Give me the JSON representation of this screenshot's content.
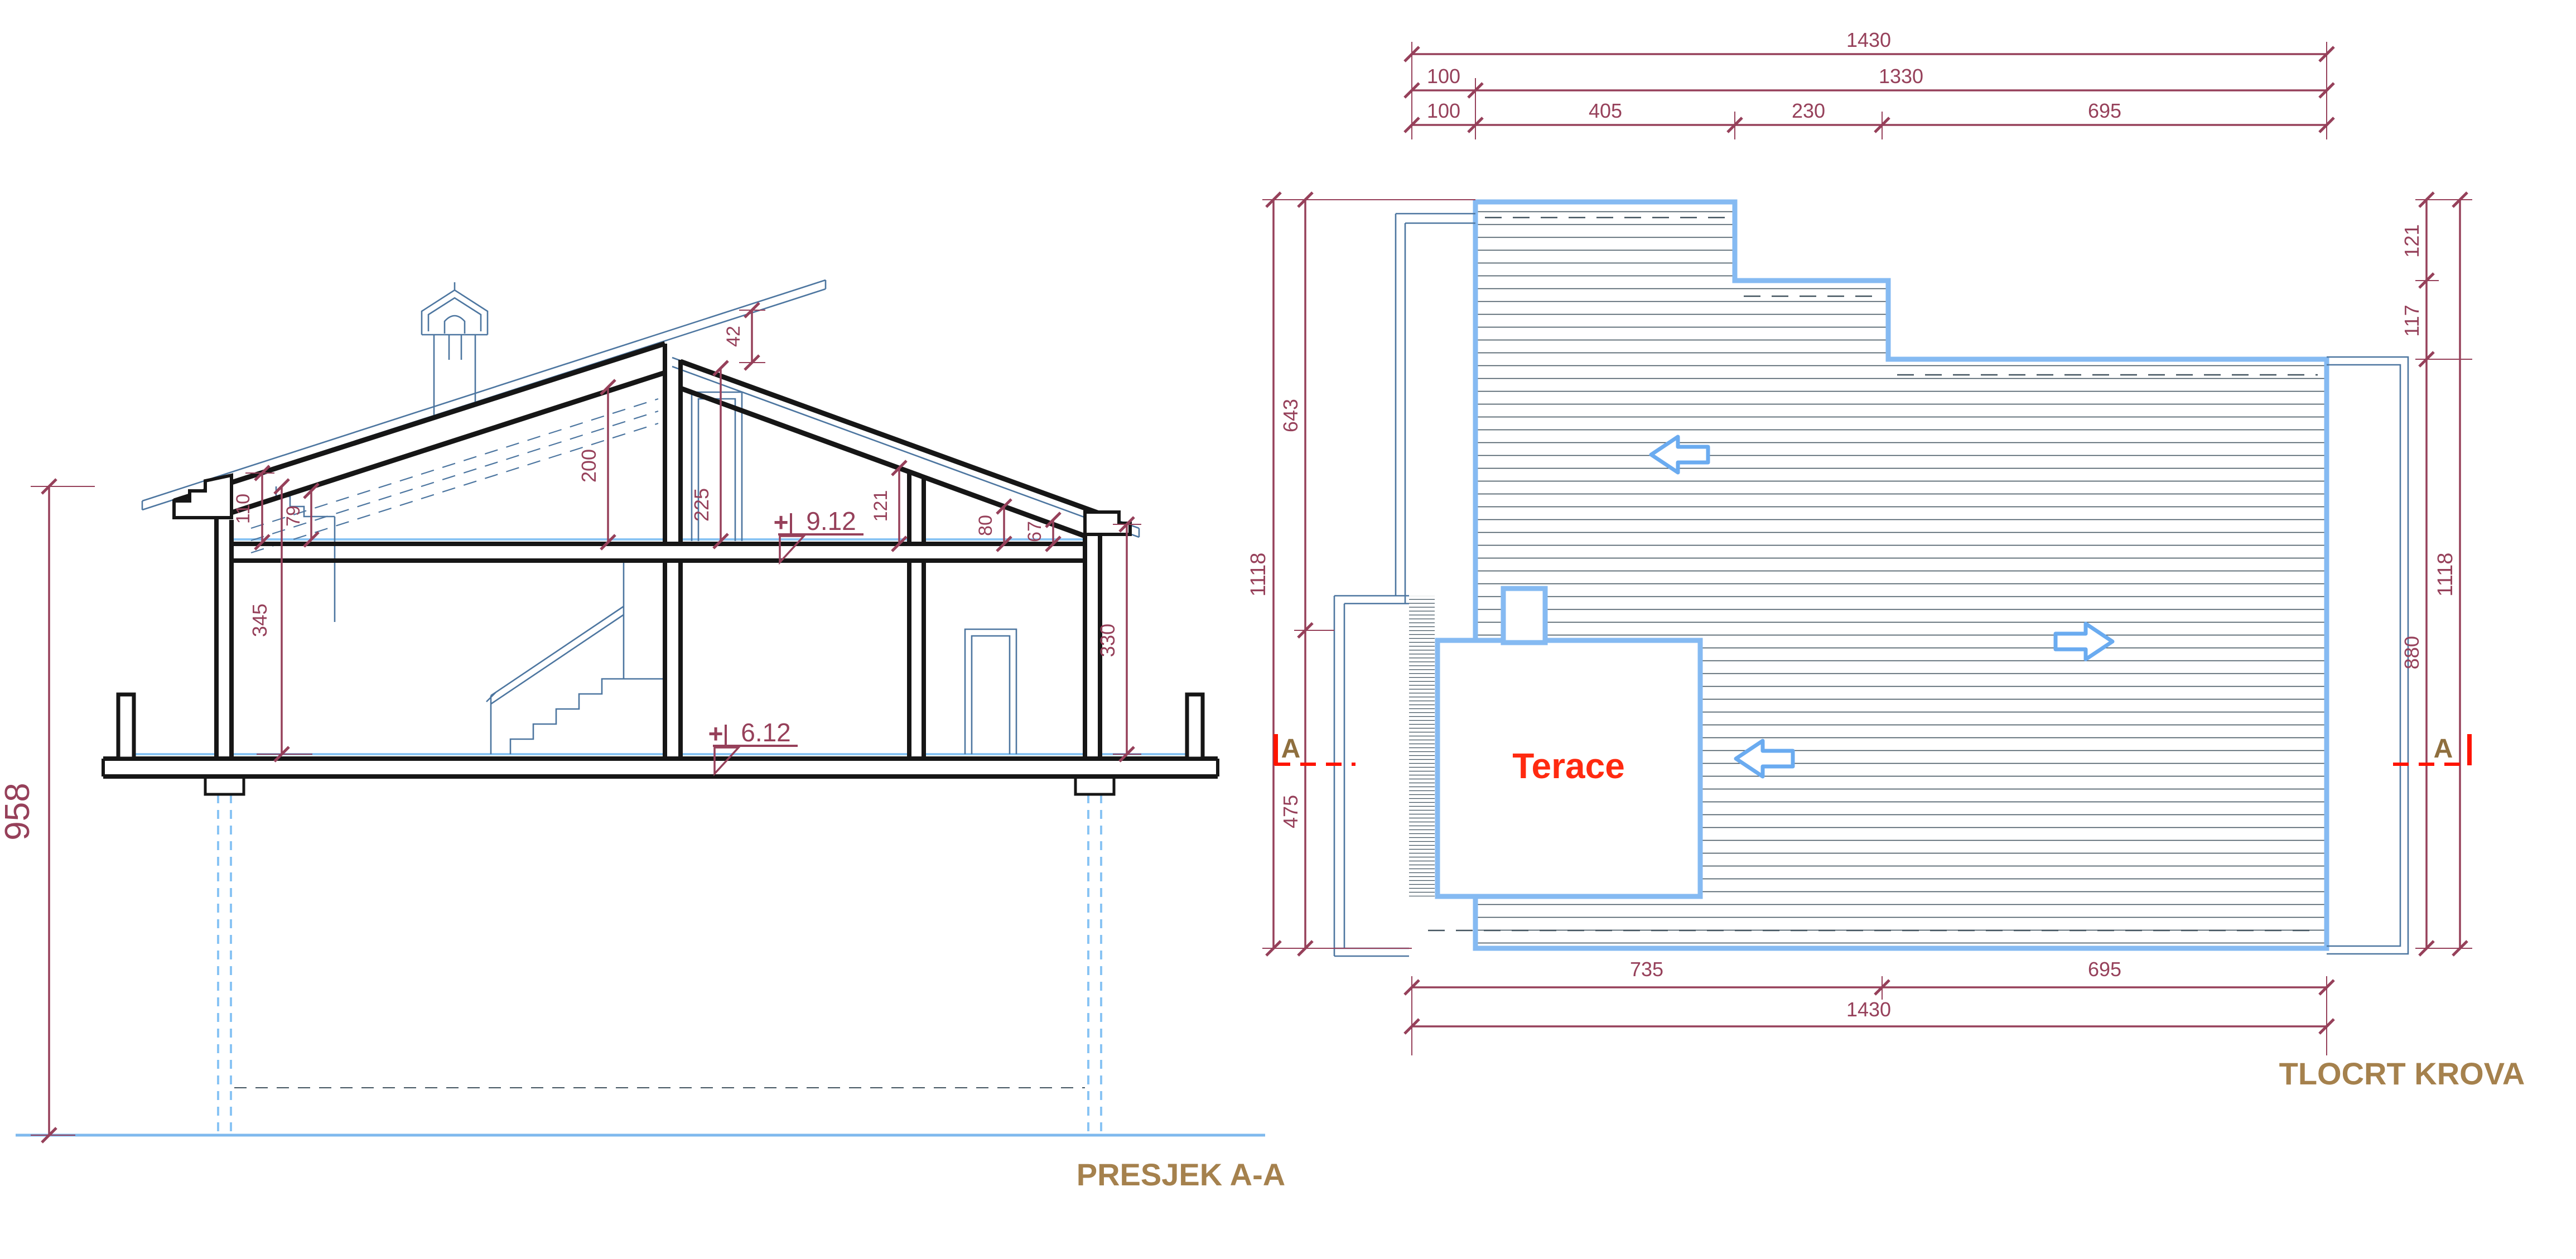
{
  "drawing": {
    "type": "architectural-drawing",
    "colors": {
      "dimension": "#96405a",
      "titles": "#a5814d",
      "roof_edge": "#85baf2",
      "thin_lines": "#4d76a0",
      "hatch": "#42535f",
      "section_cut": "#fe1400",
      "terrace_text": "#ff2a10",
      "structure": "#161616",
      "foundation": "#89c4f4"
    }
  },
  "section": {
    "title": "PRESJEK A-A",
    "levels": {
      "upper_floor": {
        "prefix": "+",
        "value": "9.12"
      },
      "ground_floor": {
        "prefix": "+",
        "value": "6.12"
      }
    },
    "dims": {
      "overall_height": "958",
      "eave_to_floor": "345",
      "knee_wall_left": "110",
      "cornice_drop_left": "79",
      "attic_interior_height": "200",
      "clerestory_window_height": "225",
      "ridge_upstand": "42",
      "attic_wall_height": "121",
      "attic_right_a": "80",
      "attic_right_b": "67",
      "right_wall_height": "330"
    }
  },
  "roof_plan": {
    "title": "TLOCRT KROVA",
    "terrace_label": "Terace",
    "section_markers": {
      "left": "A",
      "right": "A"
    },
    "dims": {
      "top_total": "1430",
      "top_row2": [
        "100",
        "1330"
      ],
      "top_row3": [
        "100",
        "405",
        "230",
        "695"
      ],
      "left_outer_total": "1118",
      "left_inner": [
        "643",
        "475"
      ],
      "right_inner": [
        "121",
        "117",
        "880"
      ],
      "right_outer_total": "1118",
      "bottom_row1": [
        "735",
        "695"
      ],
      "bottom_total": "1430"
    }
  }
}
